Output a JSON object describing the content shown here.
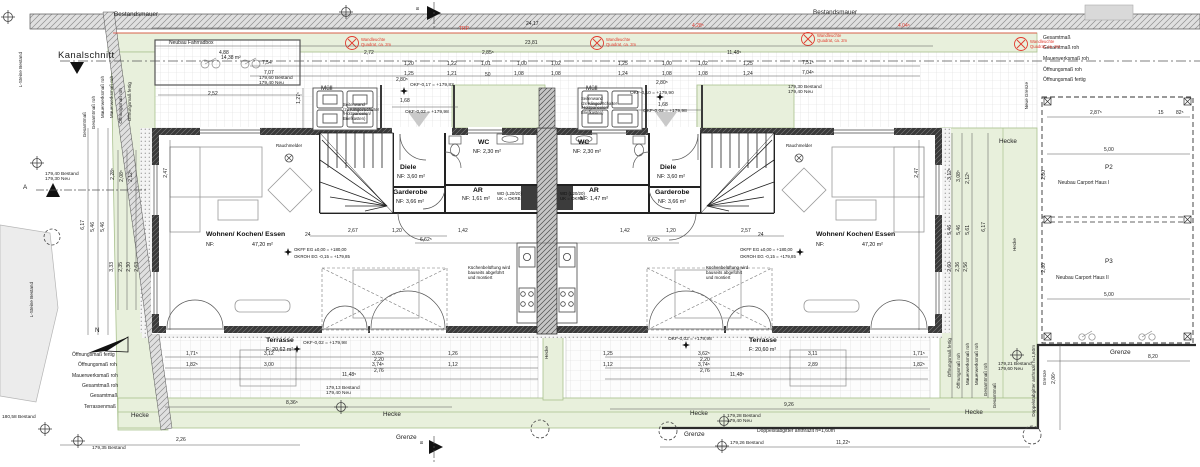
{
  "site": {
    "bestandsmauer": "Bestandsmauer",
    "kanalschnitt": "Kanalschnitt",
    "l_steine": "L-Steine Bestand",
    "neue_grenze": "Neue Grenze",
    "hecke": "Hecke",
    "grenze": "Grenze",
    "doppelstabgitter": "Doppelstabgitter anthrazit h=1,60m",
    "fahrradbox_label": "Neubau Fahrradbox",
    "fahrradbox_area": "14,38 m²",
    "muell": "Müll",
    "north_letter": "N"
  },
  "markers": {
    "a": "A",
    "b": "B"
  },
  "rooms": {
    "wohnen": {
      "name": "Wohnen/ Kochen/ Essen",
      "nf_label": "NF:",
      "area": "47,20 m²"
    },
    "wc": {
      "name": "WC",
      "area": "NF: 2,30 m²"
    },
    "ar_left": {
      "name": "AR",
      "area": "NF: 1,61 m²"
    },
    "ar_right": {
      "name": "AR",
      "area": "NF: 1,47 m²"
    },
    "diele": {
      "name": "Diele",
      "area": "NF: 3,60 m²"
    },
    "garderobe": {
      "name": "Garderobe",
      "area": "NF: 3,66 m²"
    },
    "terrasse_left": {
      "name": "Terrasse",
      "area": "F: 20,62 m²"
    },
    "terrasse_right": {
      "name": "Terrasse",
      "area": "F: 20,60 m²"
    }
  },
  "carport": {
    "p2": "P2",
    "p2_label": "Neubau Carport Haus I",
    "p3": "P3",
    "p3_label": "Neubau Carport Haus II"
  },
  "notes": {
    "okff": "OKFF EG ±0,00 = +180,00",
    "okroh": "OKROH EG -0,15 = +179,85",
    "rauchmelder": "Rauchmelder",
    "kueche": "Küchenbelüftung wird\nbauseits abgeführt\nund montiert",
    "wd": "WD (L20/20)\nUK = OKRB"
  },
  "colors": {
    "green_fill": "#e8f0dc",
    "green_line": "#a9c18e",
    "red": "#e23b2e",
    "wall_dark": "#2f2f2f"
  },
  "annotations": [
    {
      "t": "Bestandsmauer",
      "x": 114,
      "y": 11,
      "c": "lab",
      "n": "bestandsmauer-label"
    },
    {
      "t": "Bestandsmauer",
      "x": 813,
      "y": 9,
      "c": "lab",
      "n": "bestandsmauer-label"
    },
    {
      "t": "Kanalschnitt",
      "x": 58,
      "y": 51,
      "c": "labbig",
      "n": "kanalschnitt-label"
    },
    {
      "t": "Neubau Fahrradbox",
      "x": 169,
      "y": 41,
      "c": "lab2",
      "n": "fahrradbox-label"
    },
    {
      "t": "14,38 m²",
      "x": 221,
      "y": 56,
      "c": "d"
    },
    {
      "t": "Müll",
      "x": 321,
      "y": 85,
      "c": "lab",
      "n": "muell-label"
    },
    {
      "t": "Müll",
      "x": 586,
      "y": 85,
      "c": "lab",
      "n": "muell-label"
    },
    {
      "t": "Seitenwand\n(2x Klingel/Schalter\n/Holzpaneelen/\nBriefkasten)",
      "x": 343,
      "y": 103,
      "c": "note",
      "n": "seitenwand-note"
    },
    {
      "t": "Seitenwand\n(2x Klingel/Schalter\n/Holzpaneelen/\nBriefkasten)",
      "x": 581,
      "y": 97,
      "c": "note",
      "n": "seitenwand-note"
    },
    {
      "t": "L-Steine Bestand",
      "x": 18,
      "y": 52,
      "c": "labv",
      "n": "l-steine-label"
    },
    {
      "t": "L-Steine Bestand",
      "x": 29,
      "y": 282,
      "c": "labv",
      "n": "l-steine-label"
    },
    {
      "t": "Neue Grenze",
      "x": 1024,
      "y": 82,
      "c": "labv",
      "n": "neue-grenze-label"
    },
    {
      "t": "Hecke",
      "x": 999,
      "y": 138,
      "c": "lab",
      "n": "hecke-label"
    },
    {
      "t": "Hecke",
      "x": 1012,
      "y": 238,
      "c": "labv",
      "n": "hecke-label"
    },
    {
      "t": "Hecke",
      "x": 544,
      "y": 346,
      "c": "labv",
      "n": "hecke-label"
    },
    {
      "t": "Hecke",
      "x": 131,
      "y": 412,
      "c": "lab",
      "n": "hecke-label"
    },
    {
      "t": "Hecke",
      "x": 383,
      "y": 411,
      "c": "lab",
      "n": "hecke-label"
    },
    {
      "t": "Hecke",
      "x": 690,
      "y": 410,
      "c": "lab",
      "n": "hecke-label"
    },
    {
      "t": "Hecke",
      "x": 965,
      "y": 409,
      "c": "lab",
      "n": "hecke-label"
    },
    {
      "t": "Grenze",
      "x": 396,
      "y": 434,
      "c": "lab",
      "n": "grenze-label"
    },
    {
      "t": "Grenze",
      "x": 684,
      "y": 431,
      "c": "lab",
      "n": "grenze-label"
    },
    {
      "t": "Grenze",
      "x": 1110,
      "y": 349,
      "c": "lab",
      "n": "grenze-label"
    },
    {
      "t": "Grenze",
      "x": 1042,
      "y": 370,
      "c": "labv",
      "n": "grenze-label"
    },
    {
      "t": "Doppelstabgitter anthrazit h=1,60m",
      "x": 757,
      "y": 429,
      "c": "lab2",
      "n": "fence-label"
    },
    {
      "t": "Doppelstabgitter anthrazit h=1,60m",
      "x": 1031,
      "y": 345,
      "c": "labv",
      "n": "fence-label"
    },
    {
      "t": "A",
      "x": 23,
      "y": 184,
      "c": "lab",
      "n": "section-a-label"
    },
    {
      "t": "B",
      "x": 415,
      "y": 7,
      "c": "labv",
      "n": "section-b-label"
    },
    {
      "t": "B",
      "x": 419,
      "y": 441,
      "c": "labv",
      "n": "section-b-label"
    },
    {
      "t": "N",
      "x": 95,
      "y": 327,
      "c": "lab",
      "n": "north-letter"
    },
    {
      "t": "P2",
      "x": 1105,
      "y": 164,
      "c": "lab",
      "n": "carport-p2"
    },
    {
      "t": "Neubau Carport Haus I",
      "x": 1058,
      "y": 181,
      "c": "lab2",
      "n": "carport-p2-label"
    },
    {
      "t": "P3",
      "x": 1105,
      "y": 258,
      "c": "lab",
      "n": "carport-p3"
    },
    {
      "t": "Neubau Carport Haus II",
      "x": 1056,
      "y": 276,
      "c": "lab2",
      "n": "carport-p3-label"
    },
    {
      "t": "5,00",
      "x": 1104,
      "y": 148,
      "c": "d"
    },
    {
      "t": "5,00",
      "x": 1104,
      "y": 293,
      "c": "d"
    },
    {
      "t": "2,80",
      "x": 1042,
      "y": 170,
      "c": "dv"
    },
    {
      "t": "2,80",
      "x": 1042,
      "y": 263,
      "c": "dv"
    },
    {
      "t": "2,87⁵",
      "x": 1090,
      "y": 111,
      "c": "d"
    },
    {
      "t": "15",
      "x": 1158,
      "y": 111,
      "c": "d"
    },
    {
      "t": "82⁵",
      "x": 1176,
      "y": 111,
      "c": "d"
    },
    {
      "t": "8,20",
      "x": 1148,
      "y": 355,
      "c": "d"
    },
    {
      "t": "2,06⁵",
      "x": 1052,
      "y": 372,
      "c": "dv"
    },
    {
      "t": "24,17",
      "x": 526,
      "y": 22,
      "c": "d"
    },
    {
      "t": "23,81",
      "x": 525,
      "y": 41,
      "c": "d"
    },
    {
      "t": "4,88",
      "x": 219,
      "y": 51,
      "c": "d"
    },
    {
      "t": "2,72",
      "x": 364,
      "y": 51,
      "c": "d"
    },
    {
      "t": "2,85⁵",
      "x": 482,
      "y": 51,
      "c": "d"
    },
    {
      "t": "11,48⁵",
      "x": 727,
      "y": 51,
      "c": "d"
    },
    {
      "t": "7,54",
      "x": 262,
      "y": 61,
      "c": "d"
    },
    {
      "t": "7,07",
      "x": 264,
      "y": 71,
      "c": "d"
    },
    {
      "t": "7,51⁵",
      "x": 802,
      "y": 61,
      "c": "d"
    },
    {
      "t": "7,04⁵",
      "x": 802,
      "y": 71,
      "c": "d"
    },
    {
      "t": "2,52",
      "x": 208,
      "y": 92,
      "c": "d"
    },
    {
      "t": "1,20",
      "x": 404,
      "y": 62,
      "c": "d"
    },
    {
      "t": "1,22",
      "x": 447,
      "y": 62,
      "c": "d"
    },
    {
      "t": "1,01",
      "x": 481,
      "y": 62,
      "c": "d"
    },
    {
      "t": "1,00",
      "x": 517,
      "y": 62,
      "c": "d"
    },
    {
      "t": "1,02",
      "x": 551,
      "y": 62,
      "c": "d"
    },
    {
      "t": "1,25",
      "x": 618,
      "y": 62,
      "c": "d"
    },
    {
      "t": "1,25",
      "x": 404,
      "y": 72,
      "c": "d"
    },
    {
      "t": "1,21",
      "x": 447,
      "y": 72,
      "c": "d"
    },
    {
      "t": "50",
      "x": 485,
      "y": 73,
      "c": "d"
    },
    {
      "t": "1,08",
      "x": 514,
      "y": 72,
      "c": "d"
    },
    {
      "t": "1,08",
      "x": 551,
      "y": 72,
      "c": "d"
    },
    {
      "t": "1,24",
      "x": 618,
      "y": 72,
      "c": "d"
    },
    {
      "t": "1,00",
      "x": 662,
      "y": 62,
      "c": "d"
    },
    {
      "t": "1,02",
      "x": 698,
      "y": 62,
      "c": "d"
    },
    {
      "t": "1,25",
      "x": 743,
      "y": 62,
      "c": "d"
    },
    {
      "t": "1,08",
      "x": 662,
      "y": 72,
      "c": "d"
    },
    {
      "t": "1,08",
      "x": 698,
      "y": 72,
      "c": "d"
    },
    {
      "t": "1,24",
      "x": 743,
      "y": 72,
      "c": "d"
    },
    {
      "t": "1,68",
      "x": 400,
      "y": 99,
      "c": "d"
    },
    {
      "t": "2,80⁵",
      "x": 396,
      "y": 78,
      "c": "d"
    },
    {
      "t": "1,68",
      "x": 658,
      "y": 103,
      "c": "d"
    },
    {
      "t": "2,80⁵",
      "x": 656,
      "y": 81,
      "c": "d"
    },
    {
      "t": "OKF-0,17 = +179,83",
      "x": 410,
      "y": 83,
      "c": "lvl"
    },
    {
      "t": "OKF-0,02 = +179,98",
      "x": 405,
      "y": 110,
      "c": "lvl"
    },
    {
      "t": "OKF-0,10 = +179,90",
      "x": 630,
      "y": 91,
      "c": "lvl"
    },
    {
      "t": "OKF-0,02 = +179,98",
      "x": 643,
      "y": 109,
      "c": "lvl"
    },
    {
      "t": "OKF-0,02 = +179,98",
      "x": 303,
      "y": 341,
      "c": "lvl"
    },
    {
      "t": "OKF-0,02 = +179,98",
      "x": 668,
      "y": 337,
      "c": "lvl"
    },
    {
      "t": "1,27⁵",
      "x": 297,
      "y": 92,
      "c": "dv"
    },
    {
      "t": "179,60 Bestand\n179,40 Neu",
      "x": 259,
      "y": 76,
      "c": "lvl"
    },
    {
      "t": "179,30 Bestand\n179,40 Neu",
      "x": 788,
      "y": 85,
      "c": "lvl"
    },
    {
      "t": "179,40 Bestand\n179,30 Neu",
      "x": 45,
      "y": 172,
      "c": "lvl"
    },
    {
      "t": "179,13 Bestand\n179,40 Neu",
      "x": 326,
      "y": 386,
      "c": "lvl"
    },
    {
      "t": "179,28 Bestand\n179,40 Neu",
      "x": 727,
      "y": 414,
      "c": "lvl"
    },
    {
      "t": "179,26 Bestand",
      "x": 730,
      "y": 441,
      "c": "lvl"
    },
    {
      "t": "179,35 Bestand",
      "x": 92,
      "y": 446,
      "c": "lvl"
    },
    {
      "t": "180,58 Bestand",
      "x": 2,
      "y": 415,
      "c": "lvl"
    },
    {
      "t": "179,21 Bestand\n179,60 Neu",
      "x": 998,
      "y": 362,
      "c": "lvl"
    },
    {
      "t": "Gesamtmaß",
      "x": 82,
      "y": 112,
      "c": "labv"
    },
    {
      "t": "Gesamtmaß roh",
      "x": 91,
      "y": 96,
      "c": "labv"
    },
    {
      "t": "Mauerwerksmaß roh",
      "x": 100,
      "y": 76,
      "c": "labv"
    },
    {
      "t": "Mauerwerksmaß roh",
      "x": 109,
      "y": 76,
      "c": "labv"
    },
    {
      "t": "Öffnungsmaß roh",
      "x": 118,
      "y": 88,
      "c": "labv"
    },
    {
      "t": "Öffnungsmaß fertig",
      "x": 127,
      "y": 82,
      "c": "labv"
    },
    {
      "t": "Gesamtmaß",
      "x": 1043,
      "y": 36,
      "c": "lab2"
    },
    {
      "t": "Gesamtmaß roh",
      "x": 1043,
      "y": 46,
      "c": "lab2"
    },
    {
      "t": "Mauerwerksmaß roh",
      "x": 1043,
      "y": 57,
      "c": "lab2"
    },
    {
      "t": "Öffnungsmaß roh",
      "x": 1043,
      "y": 68,
      "c": "lab2"
    },
    {
      "t": "Öffnungsmaß fertig",
      "x": 1043,
      "y": 78,
      "c": "lab2"
    },
    {
      "t": "Öffnungsmaß fertig",
      "x": 72,
      "y": 353,
      "c": "lab2"
    },
    {
      "t": "Öffnungsmaß roh",
      "x": 78,
      "y": 363,
      "c": "lab2"
    },
    {
      "t": "Mauerwerksmaß roh",
      "x": 72,
      "y": 374,
      "c": "lab2"
    },
    {
      "t": "Gesamtmaß roh",
      "x": 82,
      "y": 384,
      "c": "lab2"
    },
    {
      "t": "Gesamtmaß",
      "x": 90,
      "y": 394,
      "c": "lab2"
    },
    {
      "t": "Terrassenmaß",
      "x": 84,
      "y": 405,
      "c": "lab2"
    },
    {
      "t": "Öffnungsmaß fertig",
      "x": 947,
      "y": 338,
      "c": "labv"
    },
    {
      "t": "Öffnungsmaß roh",
      "x": 956,
      "y": 353,
      "c": "labv"
    },
    {
      "t": "Mauerwerksmaß roh",
      "x": 965,
      "y": 343,
      "c": "labv"
    },
    {
      "t": "Mauerwerksmaß roh",
      "x": 974,
      "y": 343,
      "c": "labv"
    },
    {
      "t": "Gesamtmaß roh",
      "x": 983,
      "y": 363,
      "c": "labv"
    },
    {
      "t": "Gesamtmaß",
      "x": 992,
      "y": 383,
      "c": "labv"
    },
    {
      "t": "6,17",
      "x": 81,
      "y": 220,
      "c": "dv"
    },
    {
      "t": "5,46",
      "x": 91,
      "y": 222,
      "c": "dv"
    },
    {
      "t": "5,46",
      "x": 101,
      "y": 222,
      "c": "dv"
    },
    {
      "t": "2,28⁵",
      "x": 111,
      "y": 168,
      "c": "dv"
    },
    {
      "t": "2,08⁵",
      "x": 120,
      "y": 170,
      "c": "dv"
    },
    {
      "t": "2,12⁵",
      "x": 129,
      "y": 170,
      "c": "dv"
    },
    {
      "t": "3,33",
      "x": 110,
      "y": 262,
      "c": "dv"
    },
    {
      "t": "2,35",
      "x": 119,
      "y": 262,
      "c": "dv"
    },
    {
      "t": "2,30",
      "x": 127,
      "y": 262,
      "c": "dv"
    },
    {
      "t": "2,63",
      "x": 135,
      "y": 262,
      "c": "dv"
    },
    {
      "t": "2,47",
      "x": 164,
      "y": 168,
      "c": "dv"
    },
    {
      "t": "2,47",
      "x": 915,
      "y": 168,
      "c": "dv"
    },
    {
      "t": "3,12⁵",
      "x": 948,
      "y": 168,
      "c": "dv"
    },
    {
      "t": "3,08⁵",
      "x": 957,
      "y": 170,
      "c": "dv"
    },
    {
      "t": "2,12⁵",
      "x": 966,
      "y": 172,
      "c": "dv"
    },
    {
      "t": "5,46",
      "x": 948,
      "y": 225,
      "c": "dv"
    },
    {
      "t": "5,46",
      "x": 957,
      "y": 225,
      "c": "dv"
    },
    {
      "t": "5,61",
      "x": 966,
      "y": 225,
      "c": "dv"
    },
    {
      "t": "6,17",
      "x": 982,
      "y": 222,
      "c": "dv"
    },
    {
      "t": "2,60",
      "x": 948,
      "y": 262,
      "c": "dv"
    },
    {
      "t": "2,36",
      "x": 956,
      "y": 262,
      "c": "dv"
    },
    {
      "t": "2,56",
      "x": 964,
      "y": 262,
      "c": "dv"
    },
    {
      "t": "1,71⁵",
      "x": 186,
      "y": 352,
      "c": "d"
    },
    {
      "t": "3,12",
      "x": 264,
      "y": 352,
      "c": "d"
    },
    {
      "t": "3,62⁵",
      "x": 372,
      "y": 352,
      "c": "d"
    },
    {
      "t": "2,20",
      "x": 374,
      "y": 358,
      "c": "d"
    },
    {
      "t": "1,26",
      "x": 448,
      "y": 352,
      "c": "d"
    },
    {
      "t": "1,82⁵",
      "x": 186,
      "y": 363,
      "c": "d"
    },
    {
      "t": "3,00",
      "x": 264,
      "y": 363,
      "c": "d"
    },
    {
      "t": "3,74⁵",
      "x": 372,
      "y": 363,
      "c": "d"
    },
    {
      "t": "2,76",
      "x": 374,
      "y": 369,
      "c": "d"
    },
    {
      "t": "1,12",
      "x": 448,
      "y": 363,
      "c": "d"
    },
    {
      "t": "11,48⁵",
      "x": 342,
      "y": 373,
      "c": "d"
    },
    {
      "t": "8,36⁵",
      "x": 286,
      "y": 401,
      "c": "d"
    },
    {
      "t": "2,26",
      "x": 176,
      "y": 438,
      "c": "d"
    },
    {
      "t": "1,25",
      "x": 603,
      "y": 352,
      "c": "d"
    },
    {
      "t": "3,62⁵",
      "x": 698,
      "y": 352,
      "c": "d"
    },
    {
      "t": "2,20",
      "x": 700,
      "y": 358,
      "c": "d"
    },
    {
      "t": "3,11",
      "x": 808,
      "y": 352,
      "c": "d"
    },
    {
      "t": "1,71⁵",
      "x": 913,
      "y": 352,
      "c": "d"
    },
    {
      "t": "1,12",
      "x": 603,
      "y": 363,
      "c": "d"
    },
    {
      "t": "3,74⁵",
      "x": 698,
      "y": 363,
      "c": "d"
    },
    {
      "t": "2,76",
      "x": 700,
      "y": 369,
      "c": "d"
    },
    {
      "t": "2,89",
      "x": 808,
      "y": 363,
      "c": "d"
    },
    {
      "t": "1,82⁵",
      "x": 913,
      "y": 363,
      "c": "d"
    },
    {
      "t": "11,48⁵",
      "x": 730,
      "y": 373,
      "c": "d"
    },
    {
      "t": "9,26",
      "x": 784,
      "y": 403,
      "c": "d"
    },
    {
      "t": "11,22⁵",
      "x": 836,
      "y": 441,
      "c": "d"
    },
    {
      "t": "2,67",
      "x": 348,
      "y": 229,
      "c": "d"
    },
    {
      "t": "1,20",
      "x": 392,
      "y": 229,
      "c": "d"
    },
    {
      "t": "24",
      "x": 305,
      "y": 233,
      "c": "d"
    },
    {
      "t": "6,62⁵",
      "x": 420,
      "y": 238,
      "c": "d"
    },
    {
      "t": "1,42",
      "x": 458,
      "y": 229,
      "c": "d"
    },
    {
      "t": "1,42",
      "x": 620,
      "y": 229,
      "c": "d"
    },
    {
      "t": "2,57",
      "x": 741,
      "y": 229,
      "c": "d"
    },
    {
      "t": "1,20",
      "x": 666,
      "y": 229,
      "c": "d"
    },
    {
      "t": "24",
      "x": 758,
      "y": 233,
      "c": "d"
    },
    {
      "t": "6,62⁵",
      "x": 648,
      "y": 238,
      "c": "d"
    },
    {
      "t": "TRP",
      "x": 459,
      "y": 27,
      "c": "red",
      "n": "red-line-label"
    },
    {
      "t": "4,28⁵",
      "x": 692,
      "y": 24,
      "c": "red"
    },
    {
      "t": "4,04⁵",
      "x": 898,
      "y": 24,
      "c": "red"
    },
    {
      "t": "Wandleuchte\nQuadrat, ca. 2m",
      "x": 361,
      "y": 38,
      "c": "rednote",
      "n": "wandleuchte-note"
    },
    {
      "t": "Wandleuchte\nQuadrat, ca. 2m",
      "x": 606,
      "y": 38,
      "c": "rednote",
      "n": "wandleuchte-note"
    },
    {
      "t": "Wandleuchte\nQuadrat, ca. 2m",
      "x": 817,
      "y": 34,
      "c": "rednote",
      "n": "wandleuchte-note"
    },
    {
      "t": "Wandleuchte\nQuadrat, ca. 2m",
      "x": 1030,
      "y": 40,
      "c": "rednote",
      "n": "wandleuchte-note"
    }
  ]
}
